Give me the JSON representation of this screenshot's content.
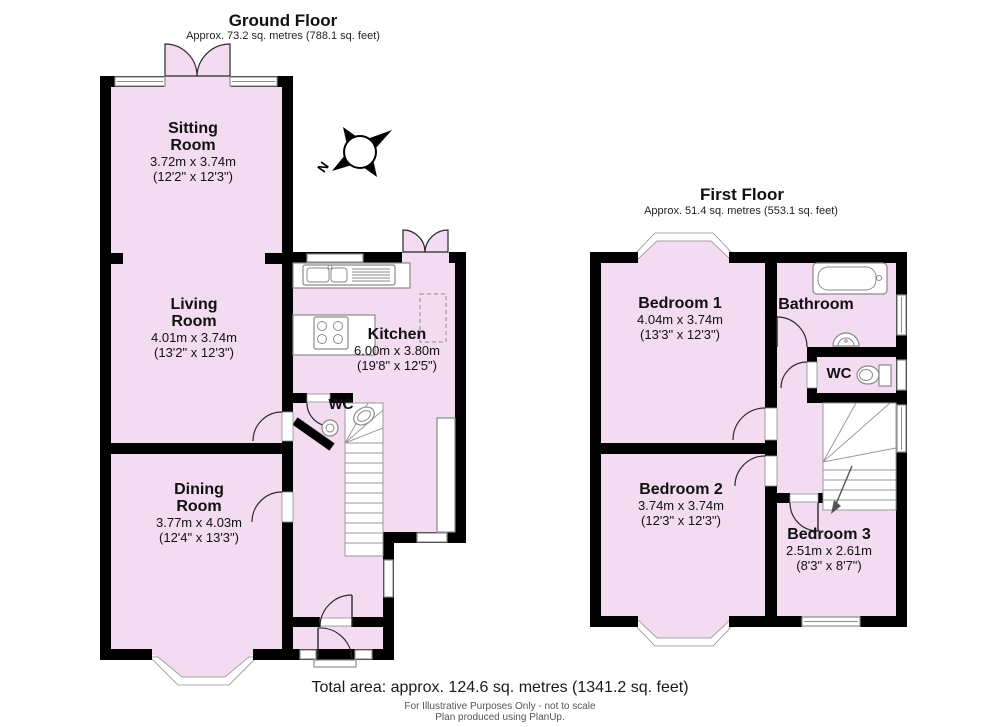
{
  "page": {
    "background": "#ffffff"
  },
  "colors": {
    "floor_fill": "#f3dbf2",
    "wall": "#000000",
    "window_frame": "#8e8e8e",
    "fixture_line": "#8a8a8a"
  },
  "compass": {
    "north_label": "N"
  },
  "floors": [
    {
      "title": "Ground Floor",
      "area_note": "Approx. 73.2 sq. metres (788.1 sq. feet)",
      "rooms": [
        {
          "name": "Sitting\nRoom",
          "metric": "3.72m x 3.74m",
          "imperial": "(12'2\" x 12'3\")"
        },
        {
          "name": "Living\nRoom",
          "metric": "4.01m x 3.74m",
          "imperial": "(13'2\" x 12'3\")"
        },
        {
          "name": "Kitchen",
          "metric": "6.00m x 3.80m",
          "imperial": "(19'8\" x 12'5\")"
        },
        {
          "name": "Dining\nRoom",
          "metric": "3.77m x 4.03m",
          "imperial": "(12'4\" x 13'3\")"
        },
        {
          "name": "WC"
        }
      ]
    },
    {
      "title": "First Floor",
      "area_note": "Approx. 51.4 sq. metres (553.1 sq. feet)",
      "rooms": [
        {
          "name": "Bedroom 1",
          "metric": "4.04m x 3.74m",
          "imperial": "(13'3\" x 12'3\")"
        },
        {
          "name": "Bathroom"
        },
        {
          "name": "WC"
        },
        {
          "name": "Bedroom 2",
          "metric": "3.74m x 3.74m",
          "imperial": "(12'3\" x 12'3\")"
        },
        {
          "name": "Bedroom 3",
          "metric": "2.51m x 2.61m",
          "imperial": "(8'3\" x 8'7\")"
        }
      ]
    }
  ],
  "footer": {
    "total_area": "Total area: approx. 124.6 sq. metres (1341.2 sq. feet)",
    "disclaimer_line1": "For Illustrative Purposes Only - not to scale",
    "disclaimer_line2": "Plan produced using PlanUp."
  }
}
